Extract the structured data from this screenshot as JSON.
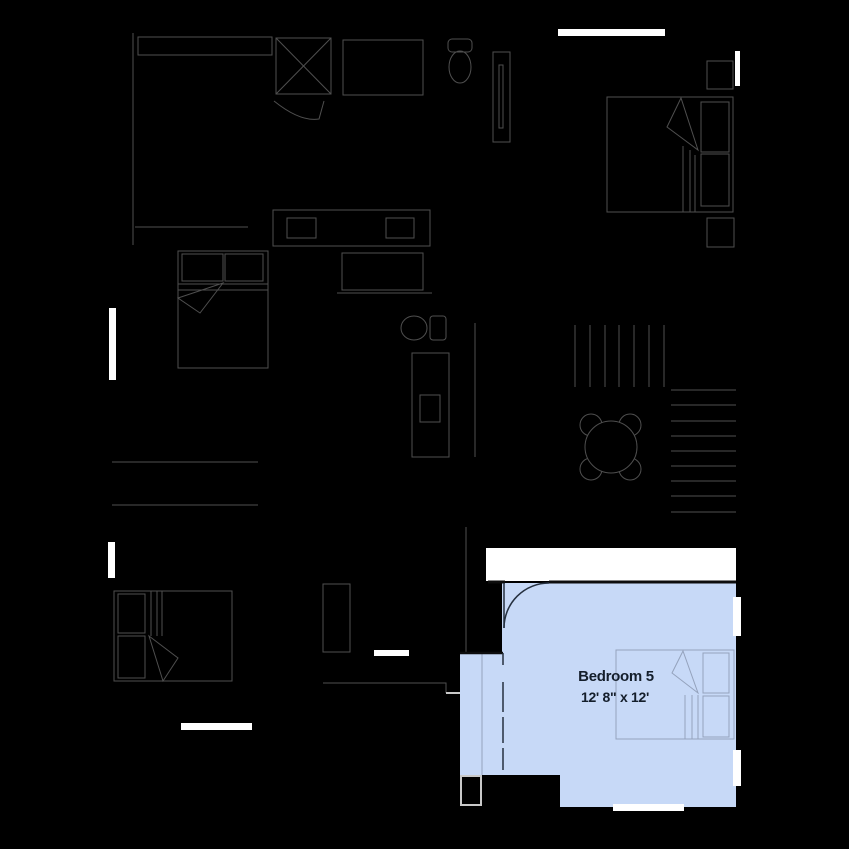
{
  "floorplan": {
    "highlighted_room": {
      "label": "Bedroom 5",
      "dimensions": "12' 8\" x 12'"
    }
  },
  "colors": {
    "bg": "#000000",
    "line": "#4f4f4f",
    "light-line": "#c9c9c9",
    "white": "#ffffff",
    "room-fill": "#c7d9f7",
    "room-line": "#94a2bc",
    "room-dark": "#25303f",
    "wall-dark": "#0d0d0d",
    "label-text": "#141e2b"
  }
}
